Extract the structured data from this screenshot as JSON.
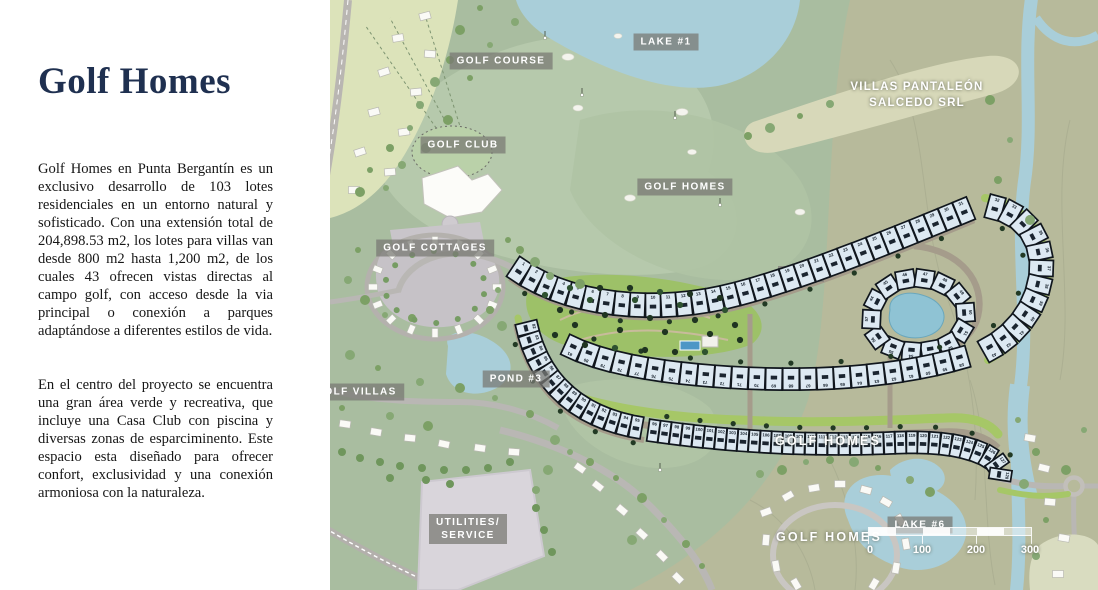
{
  "panel": {
    "title": "Golf Homes",
    "paragraph1": "Golf Homes en Punta Bergantín es un exclusivo desarrollo de 103 lotes residenciales en un entorno natural y sofisticado. Con una extensión total de 204,898.53 m2, los lotes para villas van desde 800 m2 hasta 1,200 m2, de los cuales 43 ofrecen vistas directas al campo golf, con acceso desde la via principal o conexión a parques adaptándose a diferentes estilos de vida.",
    "paragraph2": "En el centro del proyecto se encuentra una gran área verde y recreativa, que incluye una Casa Club con piscina y diversas zonas de esparciminento. Este espacio esta diseñado para ofrecer confort, exclusividad y una conexión armoniosa con la naturaleza."
  },
  "map": {
    "labels": [
      {
        "id": "golf-course",
        "lines": [
          "GOLF COURSE"
        ],
        "chip": true
      },
      {
        "id": "lake-1",
        "lines": [
          "LAKE #1"
        ],
        "chip": true
      },
      {
        "id": "villas-pantaleon",
        "lines": [
          "VILLAS PANTALEÓN",
          "SALCEDO SRL"
        ],
        "chip": false
      },
      {
        "id": "golf-club",
        "lines": [
          "GOLF CLUB"
        ],
        "chip": true
      },
      {
        "id": "golf-homes-top",
        "lines": [
          "GOLF HOMES"
        ],
        "chip": true
      },
      {
        "id": "golf-cottages",
        "lines": [
          "GOLF COTTAGES"
        ],
        "chip": true
      },
      {
        "id": "golf-villas",
        "lines": [
          "GOLF VILLAS"
        ],
        "chip": true
      },
      {
        "id": "pond-3",
        "lines": [
          "POND #3"
        ],
        "chip": true
      },
      {
        "id": "golf-homes-mid",
        "lines": [
          "GOLF HOMES"
        ],
        "chip": false,
        "big": true
      },
      {
        "id": "golf-homes-bottom",
        "lines": [
          "GOLF HOMES"
        ],
        "chip": false,
        "big": true
      },
      {
        "id": "lake-6",
        "lines": [
          "LAKE #6"
        ],
        "chip": true
      },
      {
        "id": "utilities",
        "lines": [
          "UTILITIES/",
          "SERVICE"
        ],
        "chip": true
      }
    ],
    "lake_partial_label": "LAKE",
    "scale_bar": {
      "ticks": [
        "0",
        "100",
        "200",
        "300"
      ]
    },
    "lot_bands": [
      {
        "start": 1,
        "count": 31
      },
      {
        "start": 32,
        "count": 12
      },
      {
        "start": 44,
        "count": 14
      },
      {
        "start": 58,
        "count": 24
      },
      {
        "start": 82,
        "count": 14
      },
      {
        "start": 96,
        "count": 33
      }
    ],
    "colors": {
      "water": "#a9ced9",
      "terrain_green": "#a9bda0",
      "terrain_tan": "#b7ba9b",
      "golf_light_green": "#b6c9ac",
      "accent_green": "#a6c767",
      "lot_fill": "#dde9f2",
      "lot_border": "#10161d",
      "beige_band": "#d7d8b9",
      "title_color": "#1f3050"
    }
  }
}
